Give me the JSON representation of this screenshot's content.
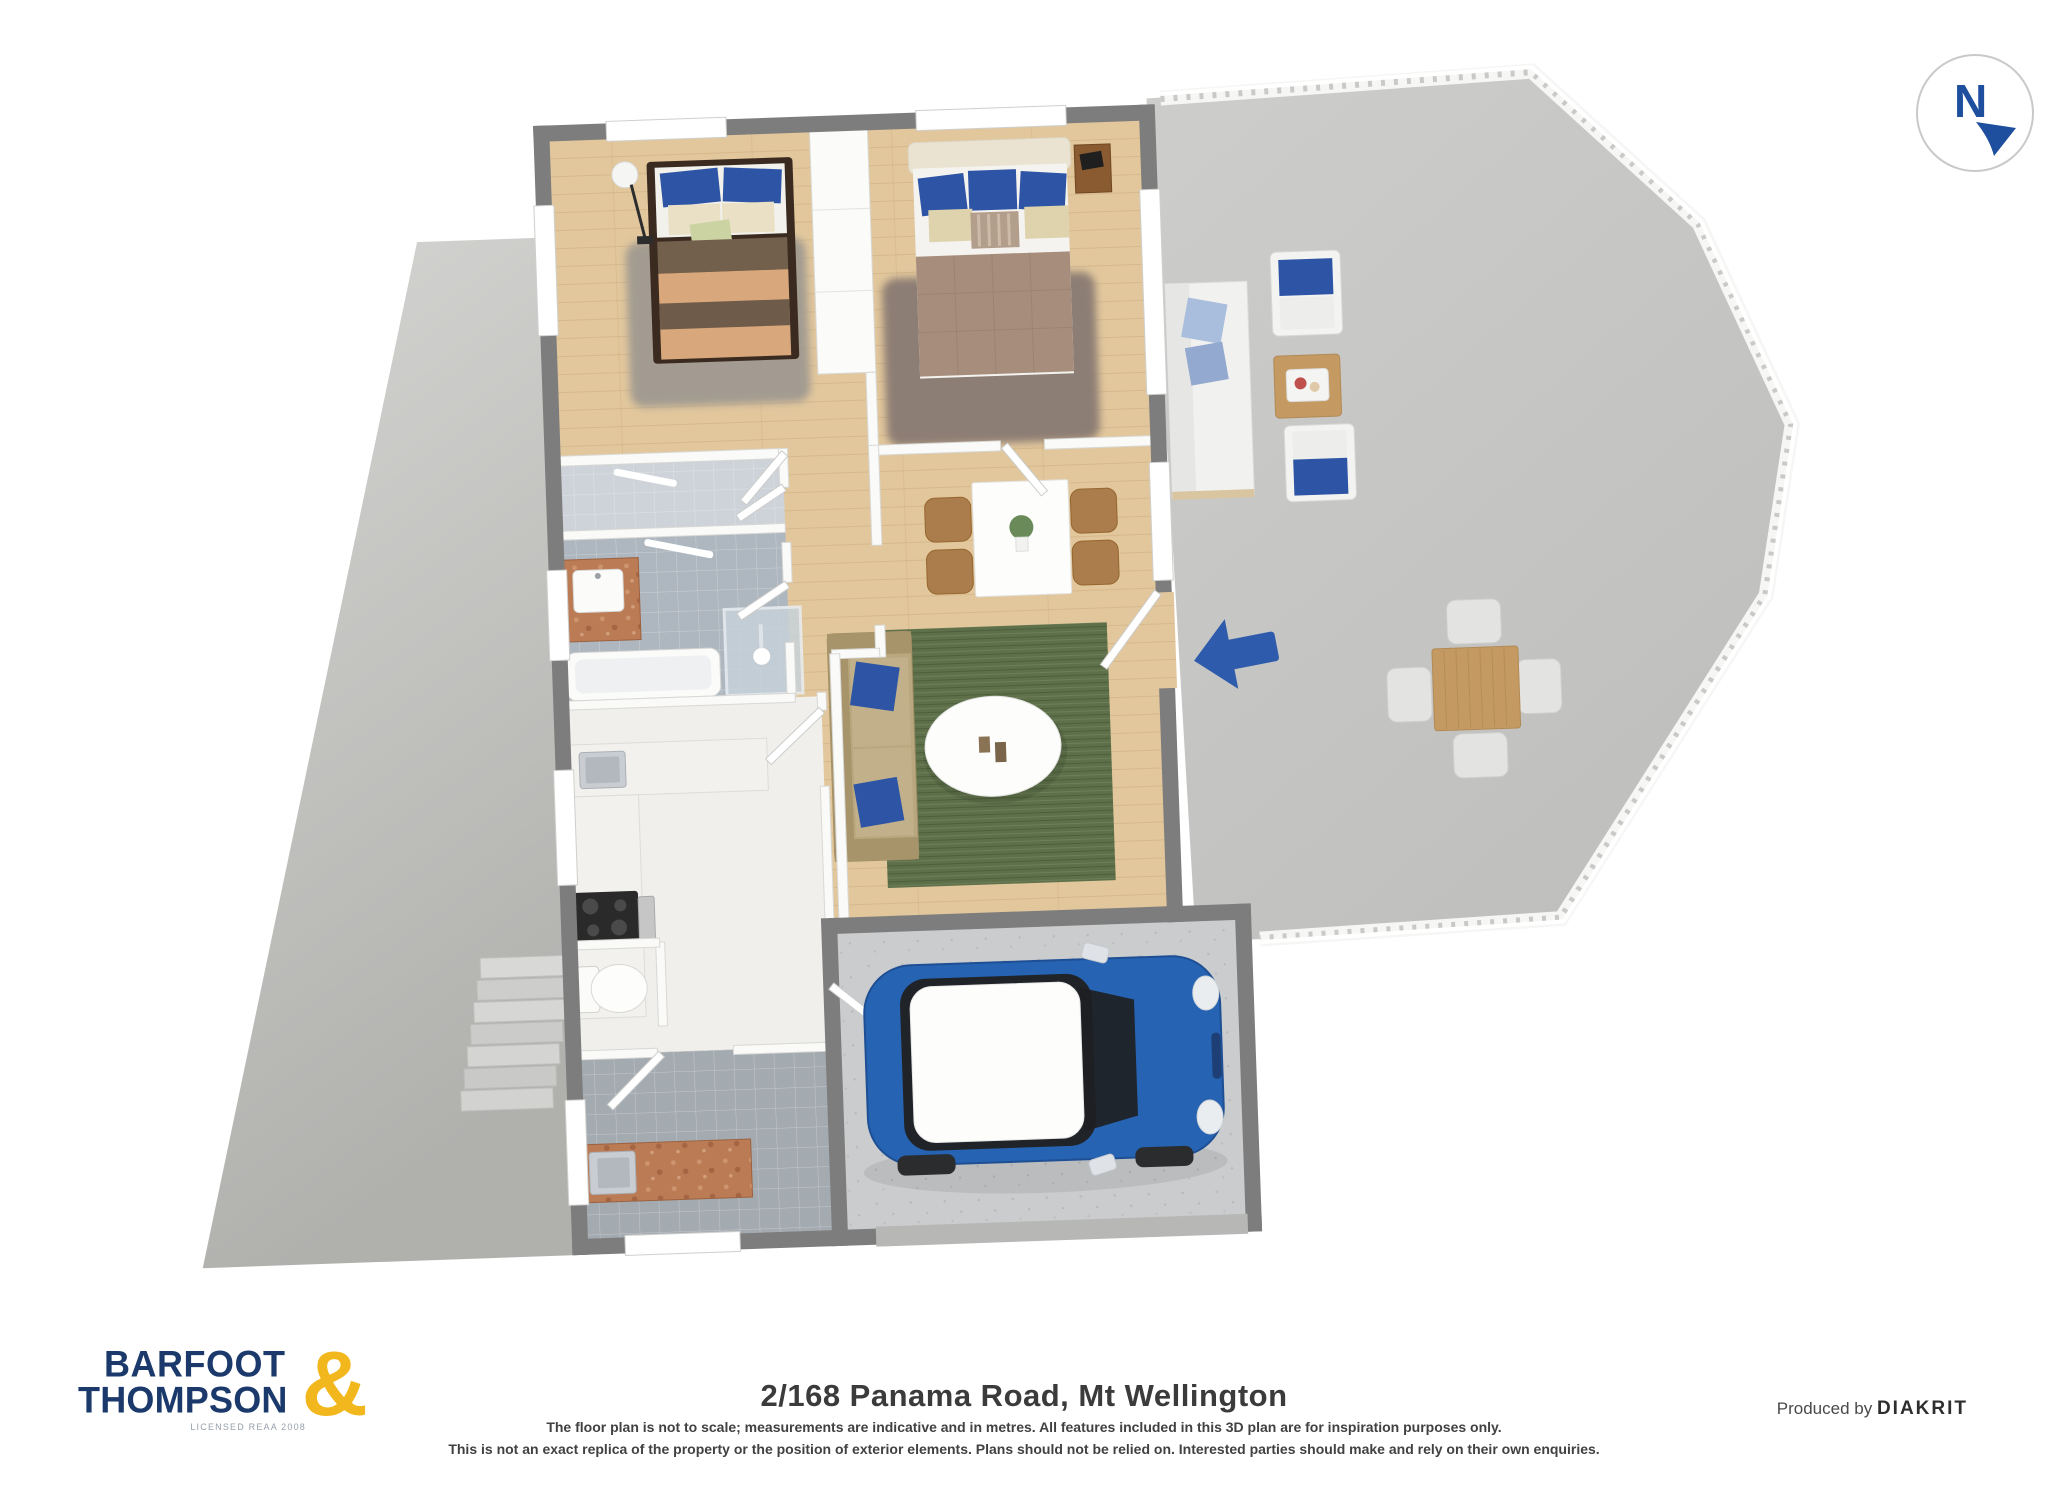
{
  "compass": {
    "label": "N"
  },
  "footer": {
    "title": "2/168 Panama Road, Mt Wellington",
    "disclaimer_line1": "The floor plan is not to scale; measurements are indicative and in metres. All features included in this 3D plan are for inspiration purposes only.",
    "disclaimer_line2": "This is not an exact replica of the property or the position of exterior elements. Plans should not be relied on. Interested parties should make and rely on their own enquiries.",
    "produced_by": "Produced by",
    "producer_brand": "DIAKRIT"
  },
  "logo": {
    "line1": "BARFOOT",
    "line2": "THOMPSON",
    "ampersand": "&",
    "tagline": "LICENSED REAA 2008"
  },
  "colors": {
    "accent-blue": "#2e5bab",
    "compass-blue": "#1e4e9e",
    "logo-navy": "#1b3a6b",
    "logo-gold": "#f3b71e",
    "wall-dark": "#7d7d7d",
    "wood-floor": "#e2c79c",
    "tile-blue": "#aeb7bf",
    "deck-gray": "#c6c6c4",
    "yard-gray": "#bdbdba",
    "rug-green": "#5d7049",
    "sofa-tan": "#b9a77f",
    "pillow-blue": "#2e55a5",
    "car-blue": "#2663b2",
    "counter-copper": "#bb7b55"
  }
}
